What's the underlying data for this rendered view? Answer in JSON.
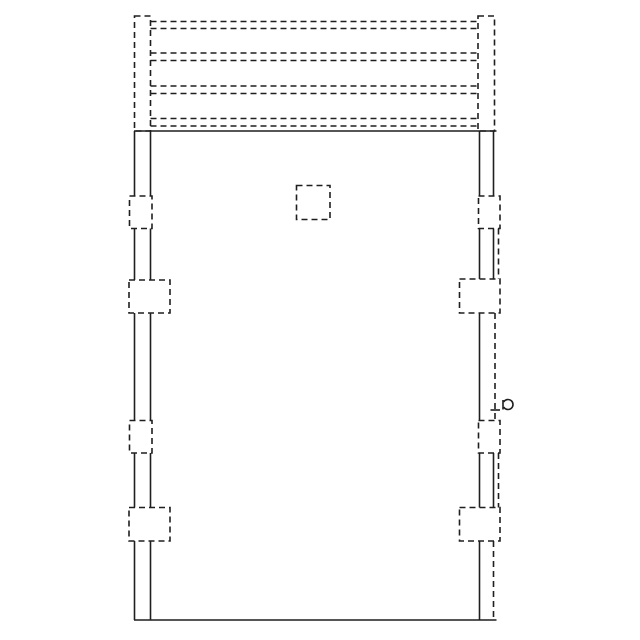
{
  "colors": {
    "background": "#ffffff",
    "line": "#1f1f1f"
  },
  "canvas": {
    "width": 640,
    "height": 640
  },
  "drawing": {
    "stroke_width": 1.6,
    "dash_pattern": "6 4",
    "solid_lines": [
      {
        "name": "frame-head-line",
        "x1": 134,
        "y1": 131,
        "x2": 496.5,
        "y2": 131
      },
      {
        "name": "frame-sill-line",
        "x1": 134,
        "y1": 620,
        "x2": 496.5,
        "y2": 620
      },
      {
        "name": "left-jamb-outer-line-1",
        "x1": 134.5,
        "y1": 131,
        "x2": 134.5,
        "y2": 196
      },
      {
        "name": "left-jamb-outer-line-2",
        "x1": 134.5,
        "y1": 228.5,
        "x2": 134.5,
        "y2": 280
      },
      {
        "name": "left-jamb-outer-line-3",
        "x1": 134.5,
        "y1": 313,
        "x2": 134.5,
        "y2": 420.5
      },
      {
        "name": "left-jamb-outer-line-4",
        "x1": 134.5,
        "y1": 453,
        "x2": 134.5,
        "y2": 507.5
      },
      {
        "name": "left-jamb-outer-line-5",
        "x1": 134.5,
        "y1": 541,
        "x2": 134.5,
        "y2": 620
      },
      {
        "name": "left-jamb-inner-line-1",
        "x1": 150.5,
        "y1": 131,
        "x2": 150.5,
        "y2": 196
      },
      {
        "name": "left-jamb-inner-line-2",
        "x1": 150.5,
        "y1": 228.5,
        "x2": 150.5,
        "y2": 280
      },
      {
        "name": "left-jamb-inner-line-3",
        "x1": 150.5,
        "y1": 313,
        "x2": 150.5,
        "y2": 420.5
      },
      {
        "name": "left-jamb-inner-line-4",
        "x1": 150.5,
        "y1": 453,
        "x2": 150.5,
        "y2": 507.5
      },
      {
        "name": "left-jamb-inner-line-5",
        "x1": 150.5,
        "y1": 541,
        "x2": 150.5,
        "y2": 620
      },
      {
        "name": "right-jamb-inner-line-1",
        "x1": 479.5,
        "y1": 131,
        "x2": 479.5,
        "y2": 196
      },
      {
        "name": "right-jamb-inner-line-2",
        "x1": 479.5,
        "y1": 228.5,
        "x2": 479.5,
        "y2": 279
      },
      {
        "name": "right-jamb-inner-line-3",
        "x1": 479.5,
        "y1": 313,
        "x2": 479.5,
        "y2": 420.5
      },
      {
        "name": "right-jamb-inner-line-4",
        "x1": 479.5,
        "y1": 453,
        "x2": 479.5,
        "y2": 507.5
      },
      {
        "name": "right-jamb-inner-line-5",
        "x1": 479.5,
        "y1": 541,
        "x2": 479.5,
        "y2": 620
      },
      {
        "name": "right-jamb-outer-line-1",
        "x1": 493.5,
        "y1": 131,
        "x2": 493.5,
        "y2": 196
      },
      {
        "name": "right-jamb-outer-line-2",
        "x1": 493.5,
        "y1": 228.5,
        "x2": 493.5,
        "y2": 279
      },
      {
        "name": "right-jamb-outer-line-3",
        "x1": 493.5,
        "y1": 453,
        "x2": 493.5,
        "y2": 507.5
      },
      {
        "name": "latch-tick-line",
        "x1": 490.5,
        "y1": 410,
        "x2": 500,
        "y2": 410
      },
      {
        "name": "knob-stem-line",
        "x1": 503,
        "y1": 400,
        "x2": 503,
        "y2": 409.5
      }
    ],
    "dashed_lines": [
      {
        "name": "louver-blade-line-1",
        "x1": 150.5,
        "y1": 21.5,
        "x2": 478,
        "y2": 21.5
      },
      {
        "name": "louver-blade-line-2",
        "x1": 150.5,
        "y1": 28.5,
        "x2": 478,
        "y2": 28.5
      },
      {
        "name": "louver-blade-line-3",
        "x1": 150.5,
        "y1": 53,
        "x2": 478,
        "y2": 53
      },
      {
        "name": "louver-blade-line-4",
        "x1": 150.5,
        "y1": 60.5,
        "x2": 478,
        "y2": 60.5
      },
      {
        "name": "louver-blade-line-5",
        "x1": 150.5,
        "y1": 86,
        "x2": 478,
        "y2": 86
      },
      {
        "name": "louver-blade-line-6",
        "x1": 150.5,
        "y1": 93.5,
        "x2": 478,
        "y2": 93.5
      },
      {
        "name": "louver-blade-line-7",
        "x1": 150.5,
        "y1": 118.5,
        "x2": 478,
        "y2": 118.5
      },
      {
        "name": "louver-blade-line-8",
        "x1": 150.5,
        "y1": 126,
        "x2": 478,
        "y2": 126
      },
      {
        "name": "right-jamb-hidden-line-1",
        "x1": 495,
        "y1": 313,
        "x2": 495,
        "y2": 420.5
      },
      {
        "name": "right-jamb-hidden-line-2",
        "x1": 493.5,
        "y1": 541,
        "x2": 493.5,
        "y2": 620
      },
      {
        "name": "right-anchor-link-line-1",
        "x1": 498.5,
        "y1": 228.5,
        "x2": 498.5,
        "y2": 279
      },
      {
        "name": "right-anchor-link-line-2",
        "x1": 498.5,
        "y1": 453,
        "x2": 498.5,
        "y2": 507.5
      }
    ],
    "dashed_rects": [
      {
        "name": "transom-left-post",
        "x": 134.5,
        "y": 16,
        "w": 16,
        "h": 115
      },
      {
        "name": "transom-right-post",
        "x": 478,
        "y": 16,
        "w": 16.5,
        "h": 115
      },
      {
        "name": "viewer-square",
        "x": 296.5,
        "y": 185.5,
        "w": 33.5,
        "h": 34
      },
      {
        "name": "hinge-box-left-top",
        "x": 129.5,
        "y": 196,
        "w": 22.5,
        "h": 32.5
      },
      {
        "name": "anchor-box-left-upper",
        "x": 129,
        "y": 280,
        "w": 41,
        "h": 33
      },
      {
        "name": "hinge-box-left-bottom",
        "x": 129.5,
        "y": 420.5,
        "w": 22.5,
        "h": 32.5
      },
      {
        "name": "anchor-box-left-lower",
        "x": 129,
        "y": 507.5,
        "w": 41,
        "h": 33.5
      },
      {
        "name": "hinge-box-right-top",
        "x": 478.5,
        "y": 196,
        "w": 21.5,
        "h": 32.5
      },
      {
        "name": "anchor-box-right-upper",
        "x": 459.5,
        "y": 279,
        "w": 40.5,
        "h": 34
      },
      {
        "name": "hinge-box-right-bottom",
        "x": 478.5,
        "y": 420.5,
        "w": 21.5,
        "h": 32.5
      },
      {
        "name": "anchor-box-right-lower",
        "x": 459.5,
        "y": 507.5,
        "w": 40.5,
        "h": 33.5
      }
    ],
    "knob_arc_path": "M 503.67 402 A 5 5 0 1 1 503.67 407"
  }
}
